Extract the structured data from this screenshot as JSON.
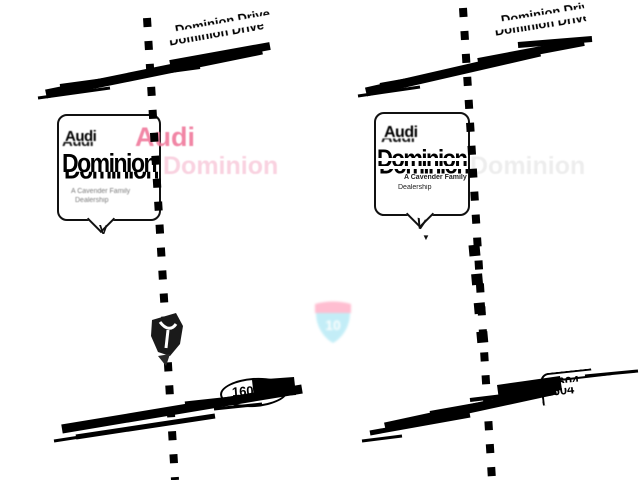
{
  "map": {
    "background": "#ffffff",
    "road_color": "#000000"
  },
  "colors": {
    "audi_red_ghost": "#f0799c",
    "ghost_pink": "#f9d2e0",
    "shield_band_pink": "#ffb3c9",
    "shield_body_cyan": "#b9ebf6"
  },
  "left_pane": {
    "street_label": "Dominion Drive",
    "route_marker": "1604",
    "callout": {
      "brand": "Audi",
      "brand_ghost": "Audi",
      "title": "Dominion",
      "title_ghost": "Dominion",
      "tagline_line1": "A Cavender Family",
      "tagline_line2": "Dealership",
      "pointer_glyph": "V"
    }
  },
  "right_pane": {
    "street_label": "Dominion Drive",
    "route_marker": "1604",
    "callout": {
      "brand": "Audi",
      "title": "Dominion",
      "title_ghost": "Dominion",
      "tagline_line1": "A Cavender Family",
      "tagline_line2": "Dealership",
      "pointer_glyph": "V",
      "pointer_tip_glyph": "▼"
    }
  },
  "interstate_shield": {
    "number": "10"
  }
}
